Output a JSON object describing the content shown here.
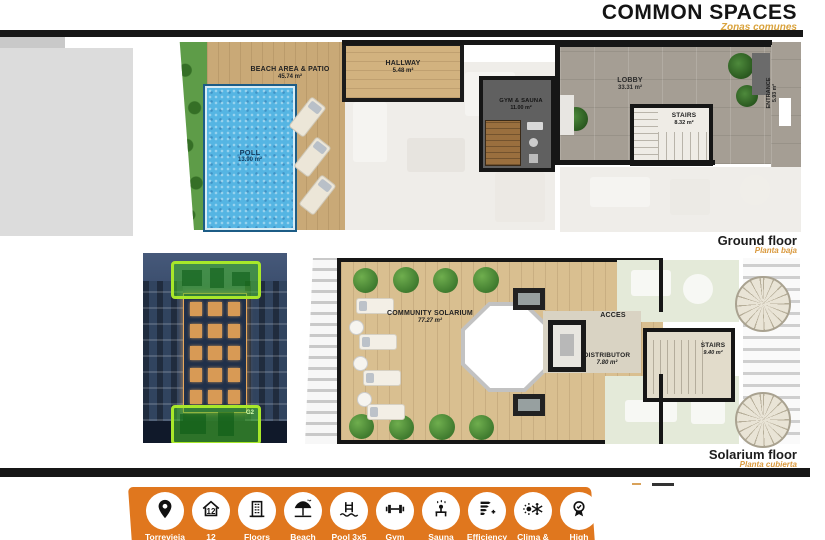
{
  "header": {
    "title": "COMMON SPACES",
    "subtitle": "Zonas comunes"
  },
  "ground": {
    "caption": "Ground floor",
    "caption_sub": "Planta baja",
    "rooms": {
      "beach": {
        "name": "BEACH AREA & PATIO",
        "area": "45.74 m²"
      },
      "pool": {
        "name": "POLL",
        "area": "13.90 m²"
      },
      "hallway": {
        "name": "HALLWAY",
        "area": "5.48 m²"
      },
      "gym": {
        "name": "GYM & SAUNA",
        "area": "11.00 m²"
      },
      "lobby": {
        "name": "LOBBY",
        "area": "33.31 m²"
      },
      "stairs": {
        "name": "STAIRS",
        "area": "8.32 m²"
      },
      "entrance": {
        "name": "ENTRANCE",
        "area": "5.93 m²"
      }
    }
  },
  "solarium": {
    "caption": "Solarium floor",
    "caption_sub": "Planta cubierta",
    "rooms": {
      "community": {
        "name": "COMMUNITY SOLARIUM",
        "area": "77.27 m²"
      },
      "acces": {
        "name": "ACCES"
      },
      "distributor": {
        "name": "DISTRIBUTOR",
        "area": "7.80 m²"
      },
      "stairs": {
        "name": "STAIRS",
        "area": "9.40 m²"
      }
    }
  },
  "photo": {
    "badge": "G2"
  },
  "amenities": {
    "items": [
      {
        "icon": "location-pin-icon",
        "label": "Torrevieja"
      },
      {
        "icon": "house-12-icon",
        "label": "12",
        "badge": "12"
      },
      {
        "icon": "building-icon",
        "label": "Floors"
      },
      {
        "icon": "beach-umbrella-icon",
        "label": "Beach"
      },
      {
        "icon": "pool-ladder-icon",
        "label": "Pool 3x5"
      },
      {
        "icon": "dumbbell-icon",
        "label": "Gym"
      },
      {
        "icon": "sauna-icon",
        "label": "Sauna"
      },
      {
        "icon": "efficiency-icon",
        "label": "Efficiency"
      },
      {
        "icon": "climate-icon",
        "label": "Clima &"
      },
      {
        "icon": "award-icon",
        "label": "High"
      }
    ]
  },
  "colors": {
    "accent_orange": "#E0771E",
    "subtitle_orange": "#D9A23C",
    "bar_black": "#171717",
    "highlight_green": "#A8E82A",
    "pool_blue": "#55B5E3"
  }
}
